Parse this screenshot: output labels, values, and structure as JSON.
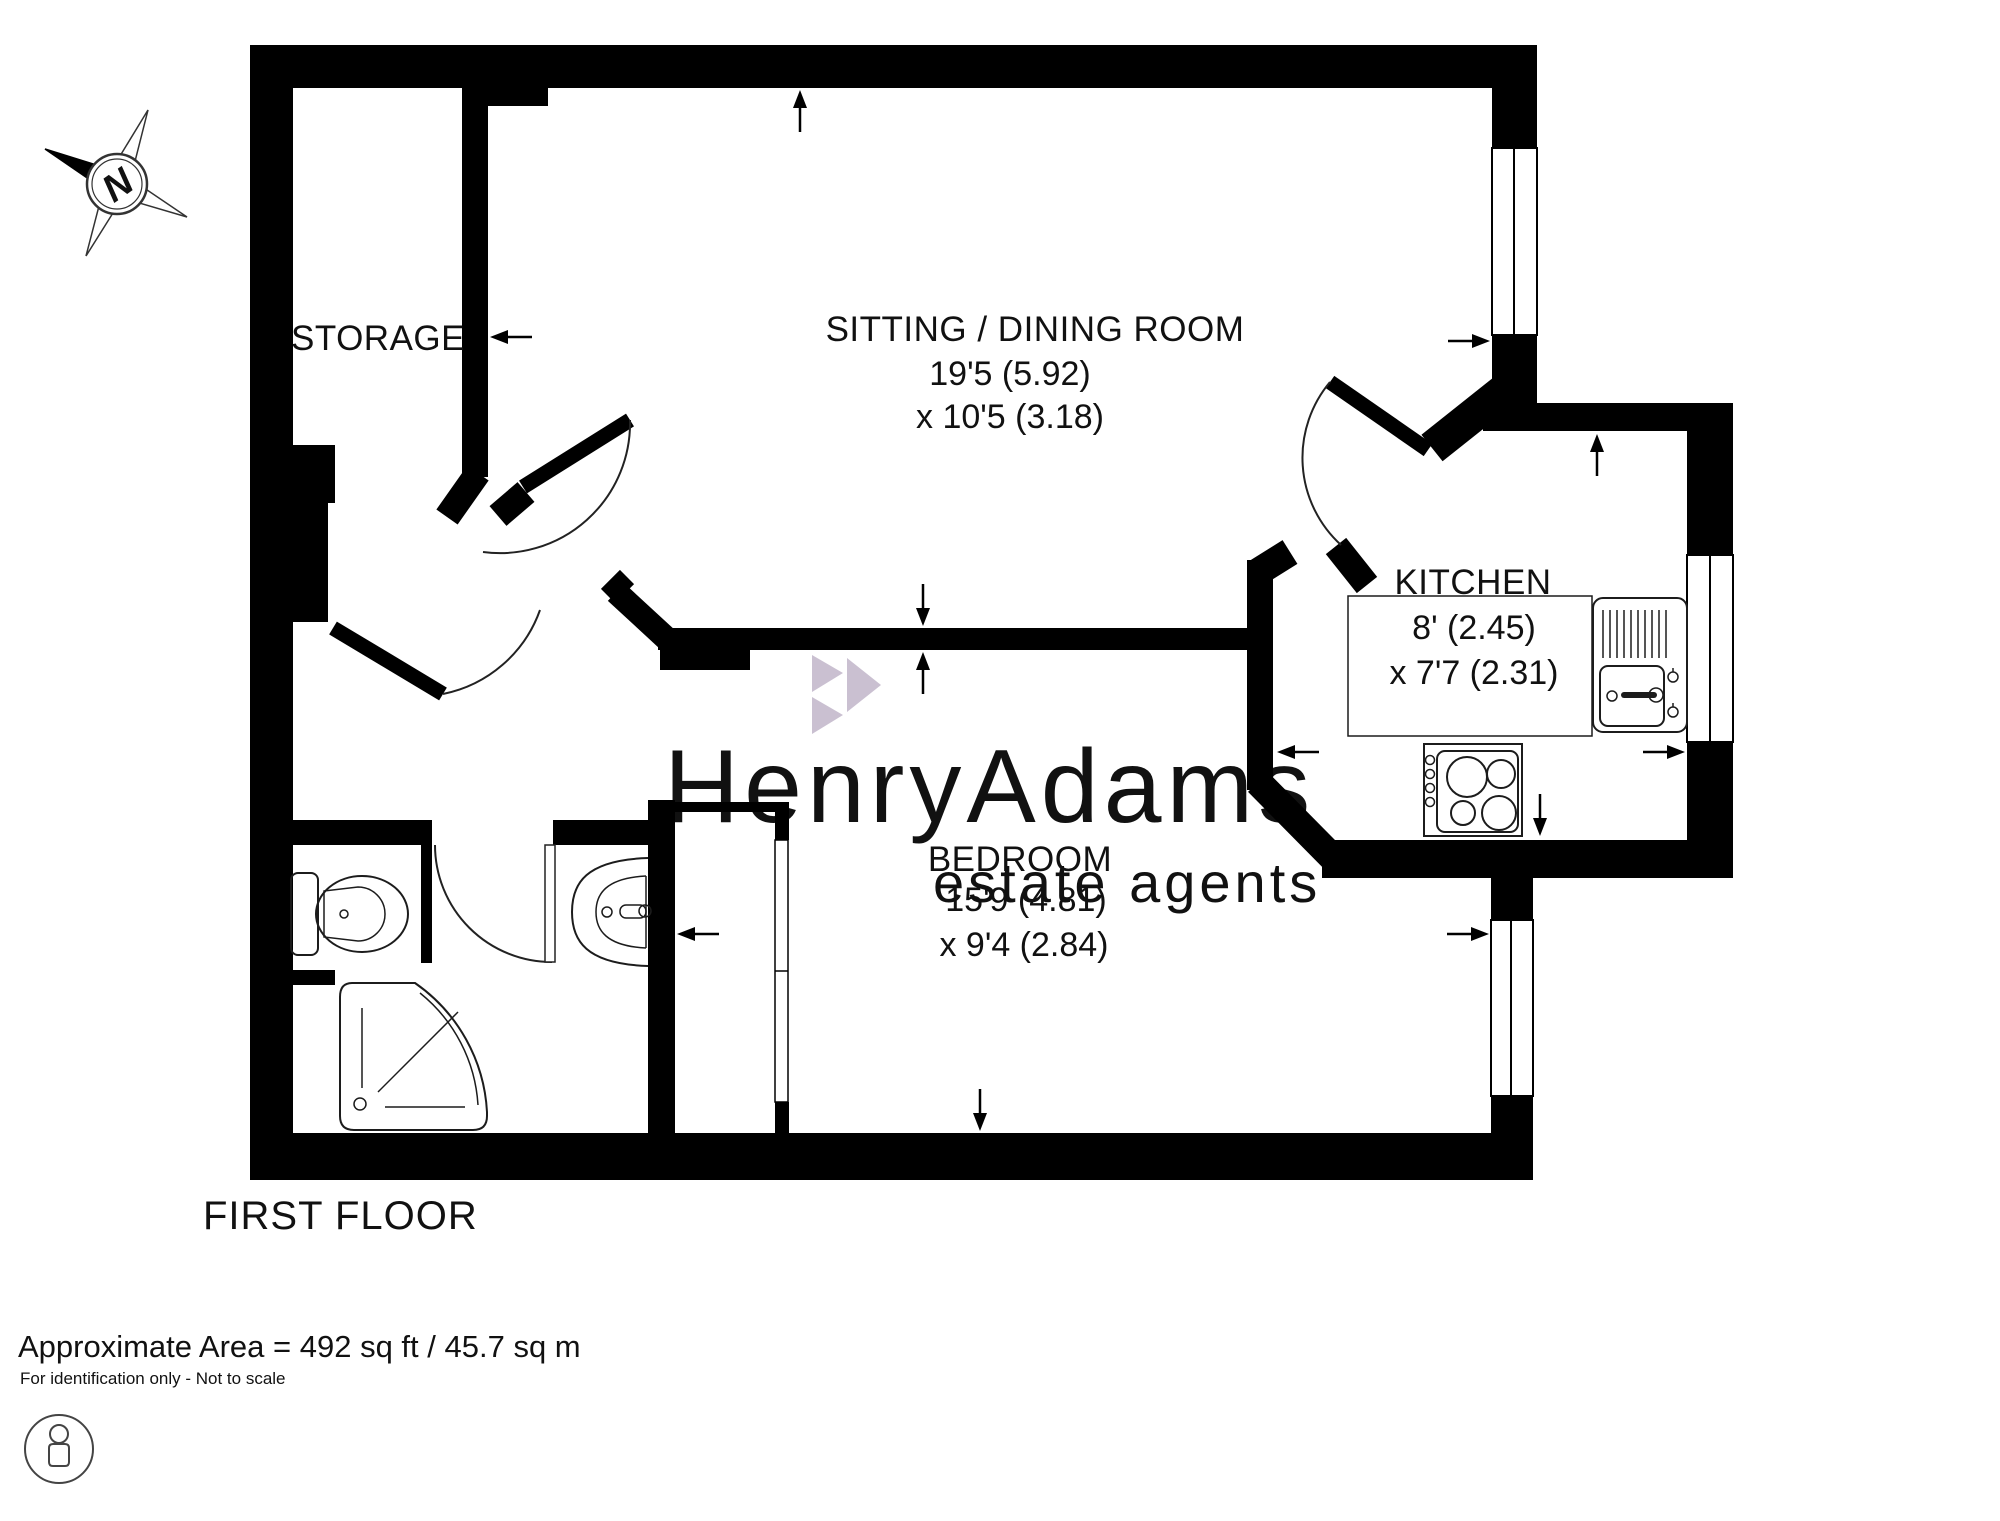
{
  "compass": {
    "letter": "N"
  },
  "rooms": {
    "storage": {
      "name": "STORAGE"
    },
    "sitting": {
      "name": "SITTING / DINING ROOM",
      "dim1": "19'5 (5.92)",
      "dim2": "x 10'5 (3.18)"
    },
    "kitchen": {
      "name": "KITCHEN",
      "dim1": "8' (2.45)",
      "dim2": "x 7'7 (2.31)"
    },
    "bedroom": {
      "name": "BEDROOM",
      "dim1": "15'9 (4.81)",
      "dim2": "x 9'4 (2.84)"
    }
  },
  "floor": {
    "label": "FIRST FLOOR"
  },
  "footer": {
    "area": "Approximate Area = 492 sq ft / 45.7 sq m",
    "disclaimer": "For identification only - Not to scale"
  },
  "watermark": {
    "name": "HenryAdams",
    "tagline": "estate agents",
    "color": "#cac0d1"
  },
  "colors": {
    "wall": "#000000",
    "fixture": "#1c1c1c"
  }
}
